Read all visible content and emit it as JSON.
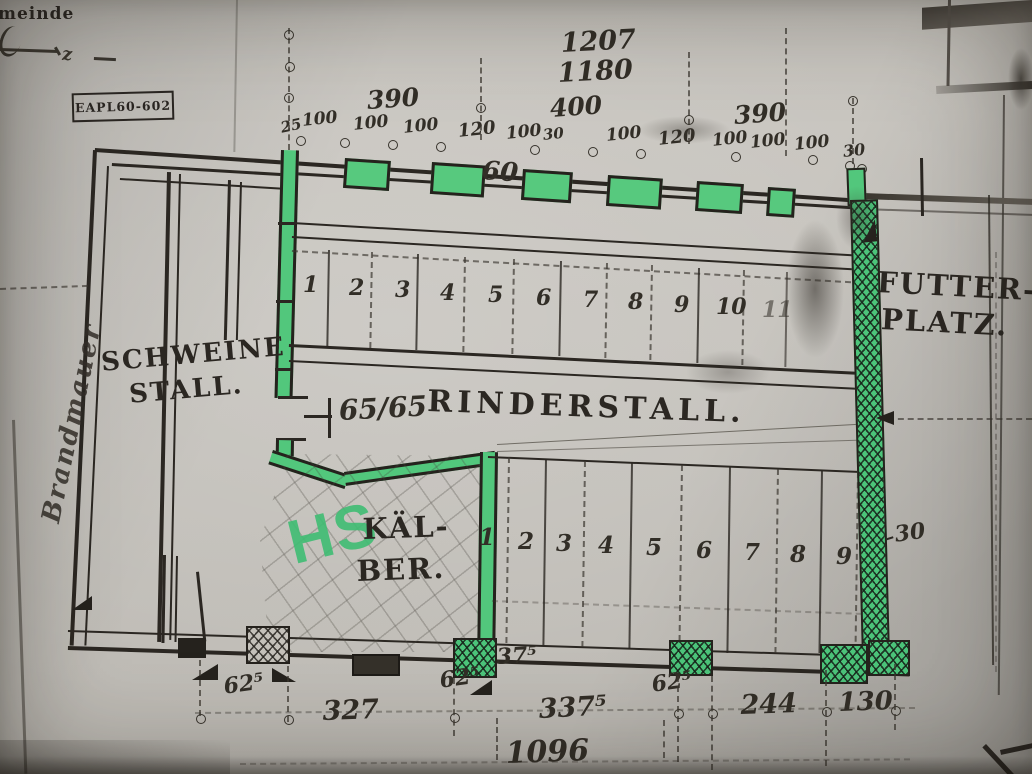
{
  "page": {
    "corner_text": "meinde",
    "handwriting_mark": "z",
    "stamp_label": "EAPL60-602",
    "wall_note": "Brandmauer"
  },
  "top_dimensions": {
    "overall": [
      "1207",
      "1180"
    ],
    "groups": [
      "390",
      "400",
      "390"
    ],
    "segments": [
      "25",
      "100",
      "100",
      "100",
      "120",
      "100",
      "30",
      "100",
      "120",
      "100",
      "100",
      "100",
      "30"
    ]
  },
  "plan": {
    "rooms": {
      "schweinestall_line1": "SCHWEINE",
      "schweinestall_line2": "STALL.",
      "rinderstall": "RINDERSTALL.",
      "kaelber_line1": "KÄL-",
      "kaelber_line2": "BER.",
      "futterplatz_line1": "FUTTER-",
      "futterplatz_line2": "PLATZ."
    },
    "marker_initials": "HS",
    "door_dimension": "65/65",
    "trough_dimension": "60",
    "right_wall_thickness": "30",
    "upper_stalls": [
      "1",
      "2",
      "3",
      "4",
      "5",
      "6",
      "7",
      "8",
      "9",
      "10",
      "11"
    ],
    "lower_stalls": [
      "1",
      "2",
      "3",
      "4",
      "5",
      "6",
      "7",
      "8",
      "9"
    ]
  },
  "bottom_dimensions": {
    "segments": [
      "62⁵",
      "327",
      "62⁵",
      "337⁵",
      "62⁵",
      "244",
      "130"
    ],
    "pier_width": "37⁵",
    "overall": "1096"
  },
  "colors": {
    "highlight_green": "#52c77c",
    "ink": "#2b2722",
    "paper": "#c9c6c0"
  }
}
